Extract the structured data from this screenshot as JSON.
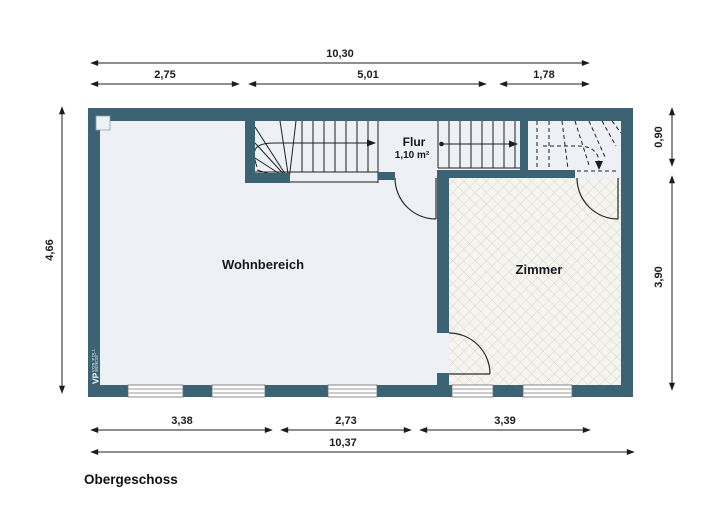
{
  "title": "Obergeschoss",
  "rooms": {
    "wohnbereich": {
      "label": "Wohnbereich"
    },
    "flur": {
      "label": "Flur",
      "area": "1,10 m²"
    },
    "zimmer": {
      "label": "Zimmer"
    }
  },
  "dimensions": {
    "top_total": "10,30",
    "top_segments": [
      "2,75",
      "5,01",
      "1,78"
    ],
    "left_total": "4,66",
    "right_segments": [
      "0,90",
      "3,90"
    ],
    "bottom_segments": [
      "3,38",
      "2,73",
      "3,39"
    ],
    "bottom_total": "10,37"
  },
  "branding": {
    "logo_main": "VP",
    "logo_sub": "VON POLL",
    "logo_sub2": "IMMOBILIEN"
  },
  "colors": {
    "wall": "#3c6374",
    "floor": "#edf1f5",
    "zimmer_floor": "#f5f4ef",
    "hatch_line": "#d8d7cb",
    "line": "#1c1c1c",
    "window_line": "#9a9a9a",
    "background": "#ffffff"
  }
}
